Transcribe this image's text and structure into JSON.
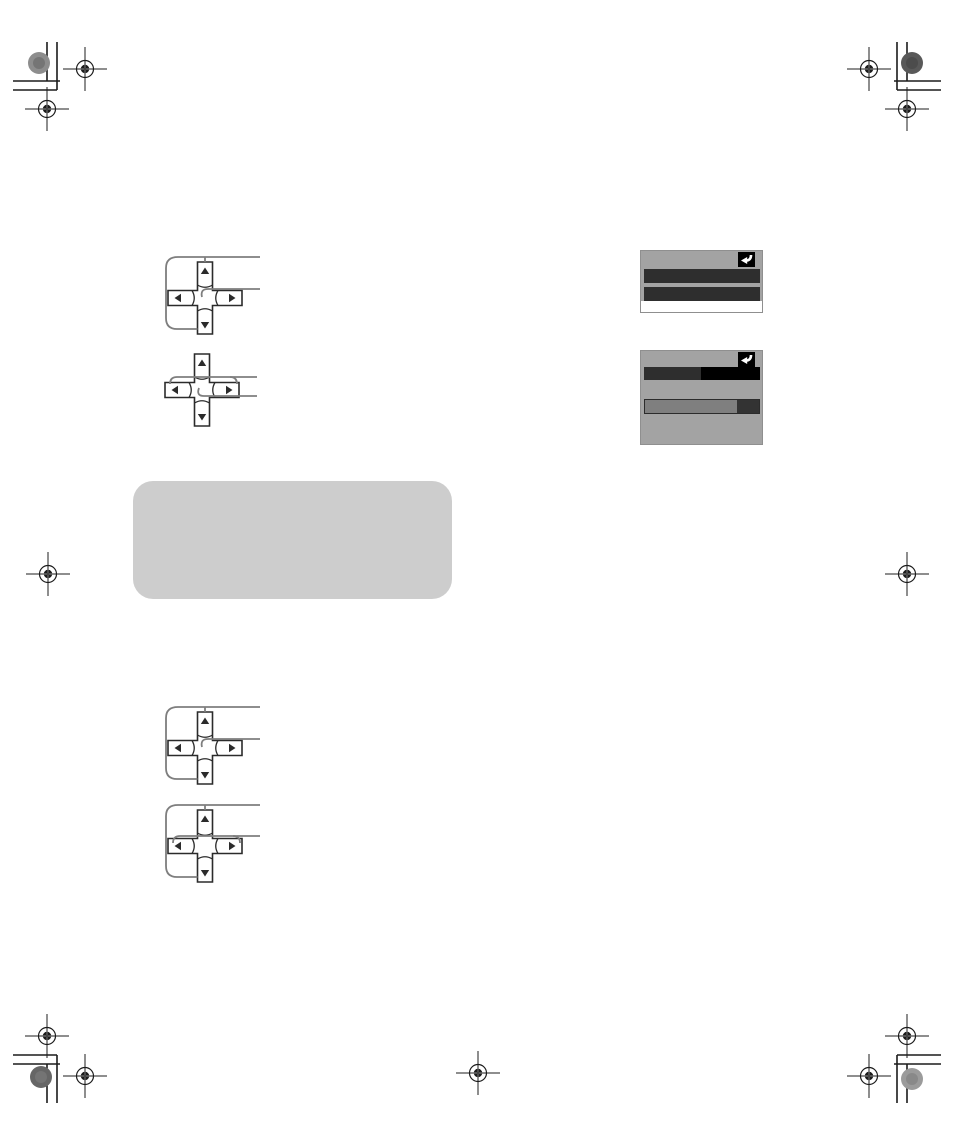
{
  "colors": {
    "page_bg": "#ffffff",
    "mark_ink": "#1c1c1c",
    "diagram_ink": "#2b2b2b",
    "callout_gray": "#7e7e7e",
    "screen_bg": "#a3a3a3",
    "screen_bar_dark": "#2e2e2e",
    "screen_bar_black": "#000000",
    "screen_bar_white": "#ffffff",
    "slider_fill": "#7f7f7f",
    "slider_knob": "#333333",
    "return_box_bg": "#000000",
    "return_arrow": "#ffffff",
    "note_box_bg": "#cdcdcd",
    "dot_top_left": "#8d8d8d",
    "dot_top_right": "#595959",
    "dot_bottom_left": "#666666",
    "dot_bottom_right": "#9b9b9b"
  },
  "print_marks": {
    "corner_trim_marks": [
      "top-left",
      "top-right",
      "bottom-left",
      "bottom-right"
    ],
    "edge_target_marks": [
      "left-middle",
      "right-middle",
      "bottom-center"
    ],
    "color_dots": [
      "top-left",
      "top-right",
      "bottom-left",
      "bottom-right"
    ]
  },
  "diagrams": {
    "dpad_arrow_glyphs": {
      "up": "▲",
      "down": "▼",
      "left": "◀",
      "right": "▶"
    },
    "items": [
      {
        "name": "dpad-top-updown",
        "callouts": [
          "up-down-buttons-bracket",
          "center-button-line"
        ]
      },
      {
        "name": "dpad-top-leftright",
        "callouts": [
          "left-right-buttons-line",
          "center-button-line"
        ]
      },
      {
        "name": "dpad-bottom-updown",
        "callouts": [
          "up-down-buttons-bracket",
          "center-button-line"
        ]
      },
      {
        "name": "dpad-bottom-all-directions",
        "callouts": [
          "up-down-buttons-bracket",
          "left-right-buttons-line"
        ]
      }
    ]
  },
  "screens": [
    {
      "name": "osd-menu-screen",
      "return_icon": "↩",
      "bars": [
        "dark",
        "dark",
        "white"
      ]
    },
    {
      "name": "osd-adjust-screen",
      "return_icon": "↩",
      "bars": [
        "dark-black-split",
        "gray-slider-with-dark-knob"
      ]
    }
  ],
  "note_box": {
    "text": ""
  }
}
